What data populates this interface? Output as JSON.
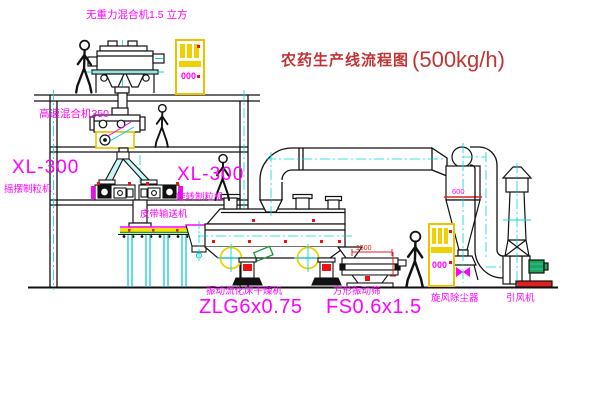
{
  "title": {
    "text_cn": "农药生产线流程图",
    "text_capacity": "(500kg/h)"
  },
  "equipment_labels": {
    "top_mixer": "无重力混合机1.5 立方",
    "high_speed_mixer": "高速混合机350",
    "granulator_left_model": "XL-300",
    "granulator_left_name": "摇摆制粒机",
    "granulator_right_model": "XL-300",
    "granulator_right_name": "旋转制粒机",
    "belt_conveyor": "皮带输送机",
    "dryer_name": "振动流化床干燥机",
    "dryer_model": "ZLG6x0.75",
    "sieve_name": "方形振动筛",
    "sieve_model": "FS0.6x1.5",
    "cyclone_name": "旋风除尘器",
    "fan_name": "引风机"
  },
  "dimensions": {
    "cyclone_outlet": "600",
    "sieve_length": "1500"
  },
  "control_cabinet_display": "000",
  "colors": {
    "label_magenta": "#ff00ff",
    "title_red": "#c23434",
    "line_black": "#111111",
    "centerline_cyan": "#00d8d8",
    "cabinet_yellow": "#e8c400",
    "accent_red": "#ee1111",
    "motor_green": "#2aa055",
    "conveyor_yellow": "#f5e200"
  }
}
